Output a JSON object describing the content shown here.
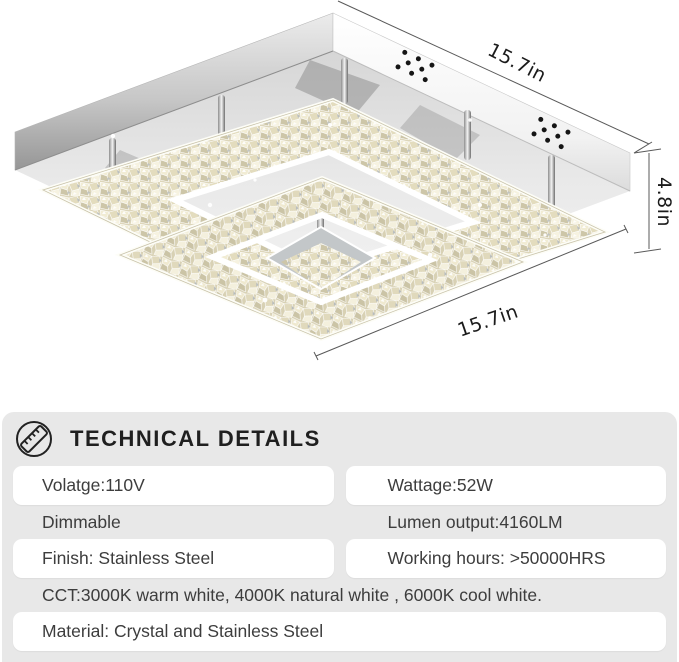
{
  "product_view": {
    "description": "crystal-two-tier-square-led-flush-mount-ceiling-light",
    "dimensions": {
      "top_width": "15.7in",
      "height": "4.8in",
      "bottom_width": "15.7in"
    }
  },
  "technical_details": {
    "icon": "ruler-icon",
    "title": "TECHNICAL DETAILS",
    "specs": [
      {
        "label": "Volatge:110V",
        "style": "pill"
      },
      {
        "label": "Wattage:52W",
        "style": "pill"
      },
      {
        "label": "Dimmable",
        "style": "plain"
      },
      {
        "label": "Lumen output:4160LM",
        "style": "plain"
      },
      {
        "label": "Finish: Stainless Steel",
        "style": "pill"
      },
      {
        "label": "Working hours: >50000HRS",
        "style": "pill"
      },
      {
        "label": "CCT:3000K warm white, 4000K natural white , 6000K cool white.",
        "style": "plain",
        "full_width": true
      },
      {
        "label": "Material: Crystal and Stainless Steel",
        "style": "pill",
        "full_width": true
      }
    ]
  },
  "colors": {
    "page_bg": "#ffffff",
    "panel_bg": "#e8e8e8",
    "pill_bg": "#ffffff",
    "spec_text": "#3d3d3d",
    "title_text": "#1f1f1f",
    "dimension_text": "#1b1b1b",
    "crystal_champagne": "#e8e2c6",
    "chrome_gray": "#c4c4c4"
  }
}
